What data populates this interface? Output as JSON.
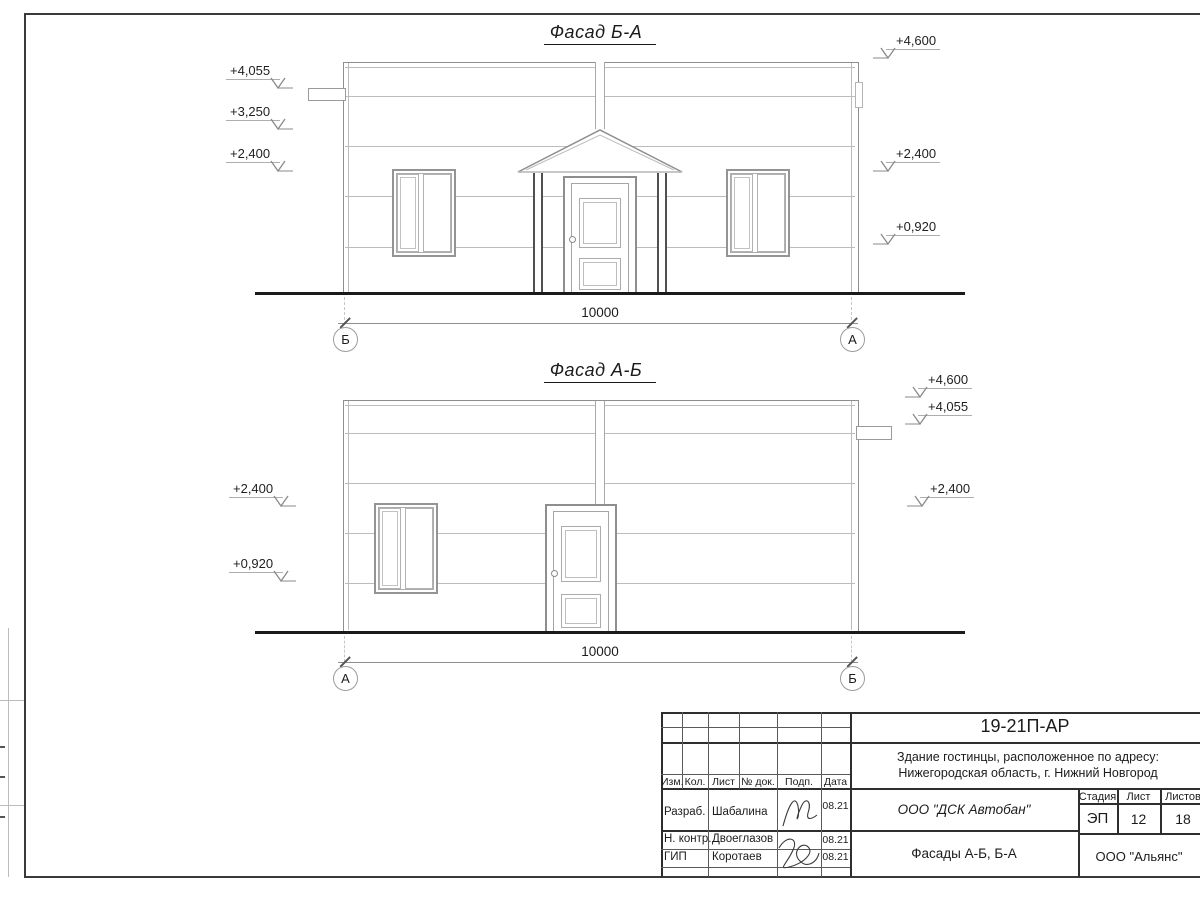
{
  "palette": {
    "paper": "#ffffff",
    "drawing_line": "#8e8e8e",
    "light_line": "#bcbcbc",
    "dark_line": "#1a1a1a",
    "text": "#1c1c1c"
  },
  "facades": {
    "top": {
      "title": "Фасад Б-А",
      "elevations_left": [
        "+4,055",
        "+3,250",
        "+2,400"
      ],
      "elevations_right": [
        "+4,600",
        "+2,400",
        "+0,920"
      ],
      "dimension": "10000",
      "axis_left": "Б",
      "axis_right": "А"
    },
    "bottom": {
      "title": "Фасад А-Б",
      "elevations_left": [
        "+2,400",
        "+0,920"
      ],
      "elevations_right": [
        "+4,600",
        "+4,055",
        "+2,400"
      ],
      "dimension": "10000",
      "axis_left": "А",
      "axis_right": "Б"
    }
  },
  "title_block": {
    "code": "19-21П-АР",
    "address_line1": "Здание гостинцы, расположенное по адресу:",
    "address_line2": "Нижегородская область, г. Нижний Новгород",
    "columns": {
      "izm": "Изм.",
      "kol": "Кол.",
      "list": "Лист",
      "doc": "№ док.",
      "podp": "Подп.",
      "data": "Дата"
    },
    "rows": [
      {
        "role": "Разраб.",
        "name": "Шабалина",
        "date": "08.21"
      },
      {
        "role": "Н. контр.",
        "name": "Двоеглазов",
        "date": "08.21"
      },
      {
        "role": "ГИП",
        "name": "Коротаев",
        "date": "08.21"
      }
    ],
    "org": "ООО \"ДСК Автобан\"",
    "doc_title": "Фасады А-Б, Б-А",
    "stage_label": "Стадия",
    "sheet_label": "Лист",
    "sheets_label": "Листов",
    "stage_value": "ЭП",
    "sheet_value": "12",
    "sheets_value": "18",
    "org2": "ООО \"Альянс\""
  }
}
